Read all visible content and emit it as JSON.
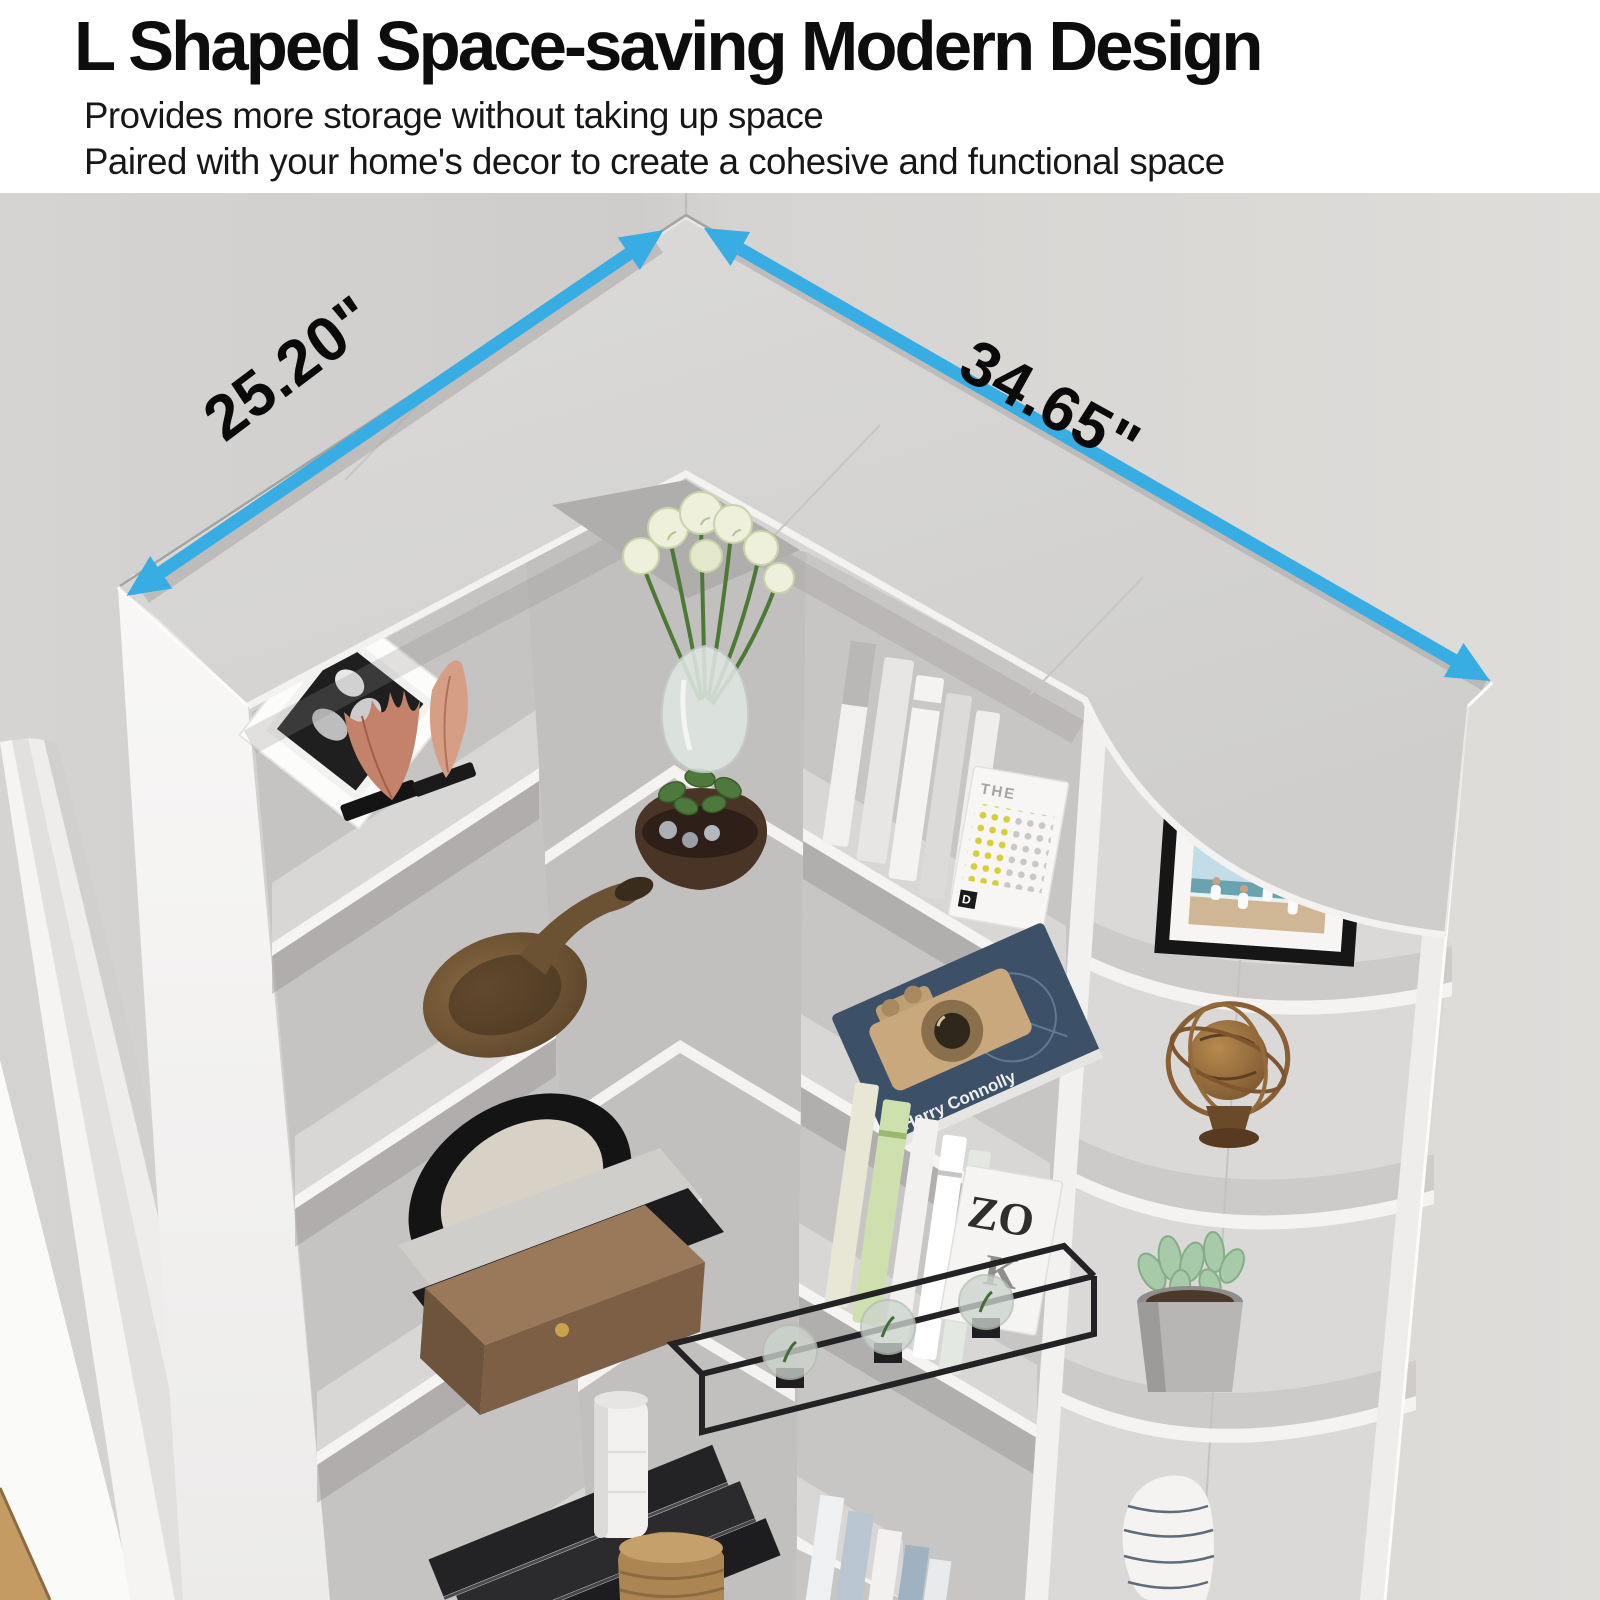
{
  "header": {
    "title": "L Shaped Space-saving Modern Design",
    "subtitle1": "Provides more storage without taking up space",
    "subtitle2": "Paired with your home's decor to create a cohesive and functional space"
  },
  "dimensions": {
    "left": "25.20\"",
    "right": "34.65\""
  },
  "books": {
    "spine": "LIFE AT THE EDGE",
    "author": "Harry Connolly",
    "dotted": "THE",
    "magazine_line1": "ZO",
    "magazine_line2": "K"
  },
  "colors": {
    "arrow": "#38ade3",
    "wall": "#d8d6d4",
    "shelf_top": "#d5d4d2",
    "panel_white": "#f5f4f3",
    "floor_wood": "#c39b63",
    "title_text": "#0d0d0d"
  },
  "scene_items": [
    "picture-frame",
    "copper-wing-ornament",
    "copper-leaf-ornament",
    "flower-vase",
    "white-books-row",
    "dotted-book",
    "brass-horn",
    "plant-bowl",
    "camera-book",
    "beach-photo-frame",
    "decorative-plate",
    "book-stack",
    "metal-planter",
    "armillary-sphere",
    "green-books-row",
    "magazine-book",
    "wooden-box",
    "succulent-pot",
    "striped-vase",
    "black-ledger-books",
    "wicker-basket",
    "white-candle-vase"
  ]
}
